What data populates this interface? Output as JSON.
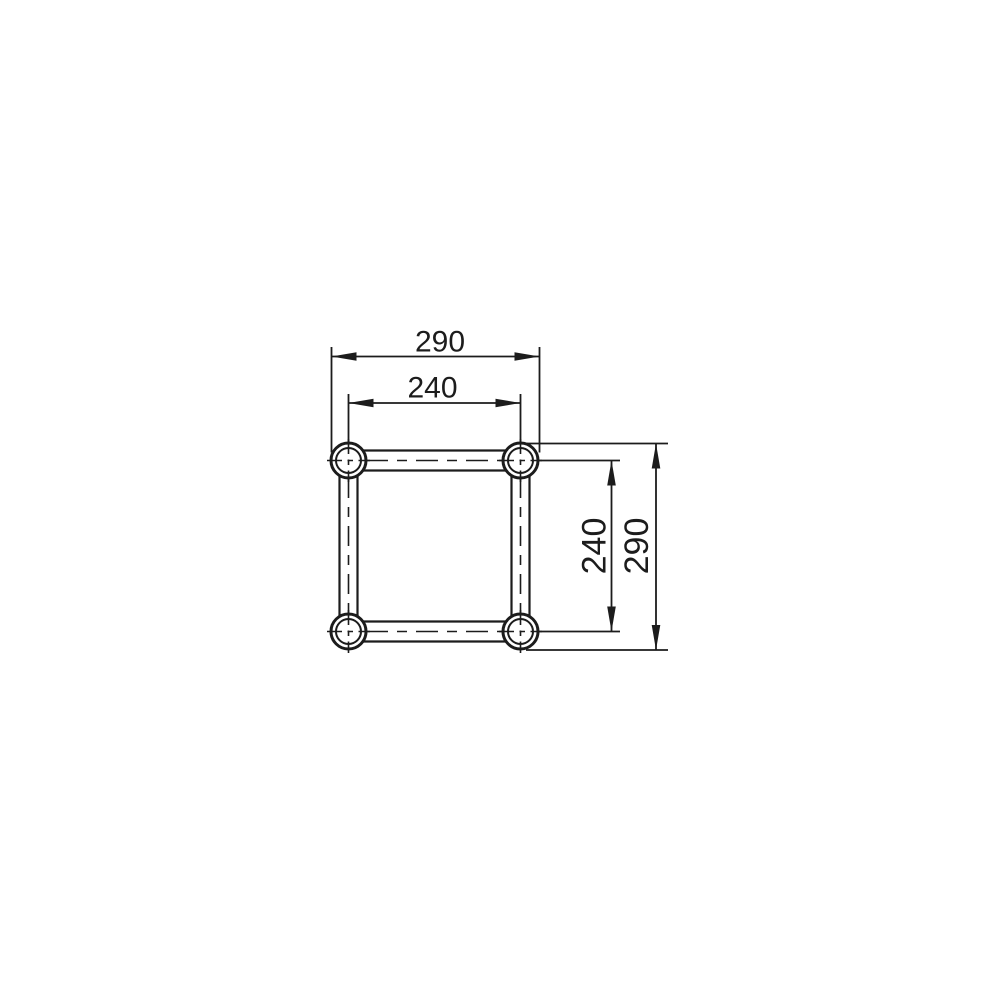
{
  "drawing": {
    "dimension_labels": {
      "outer_width": "290",
      "inner_width": "240",
      "inner_height": "240",
      "outer_height": "290"
    },
    "colors": {
      "line": "#1c1c1c",
      "background": "#ffffff"
    }
  }
}
